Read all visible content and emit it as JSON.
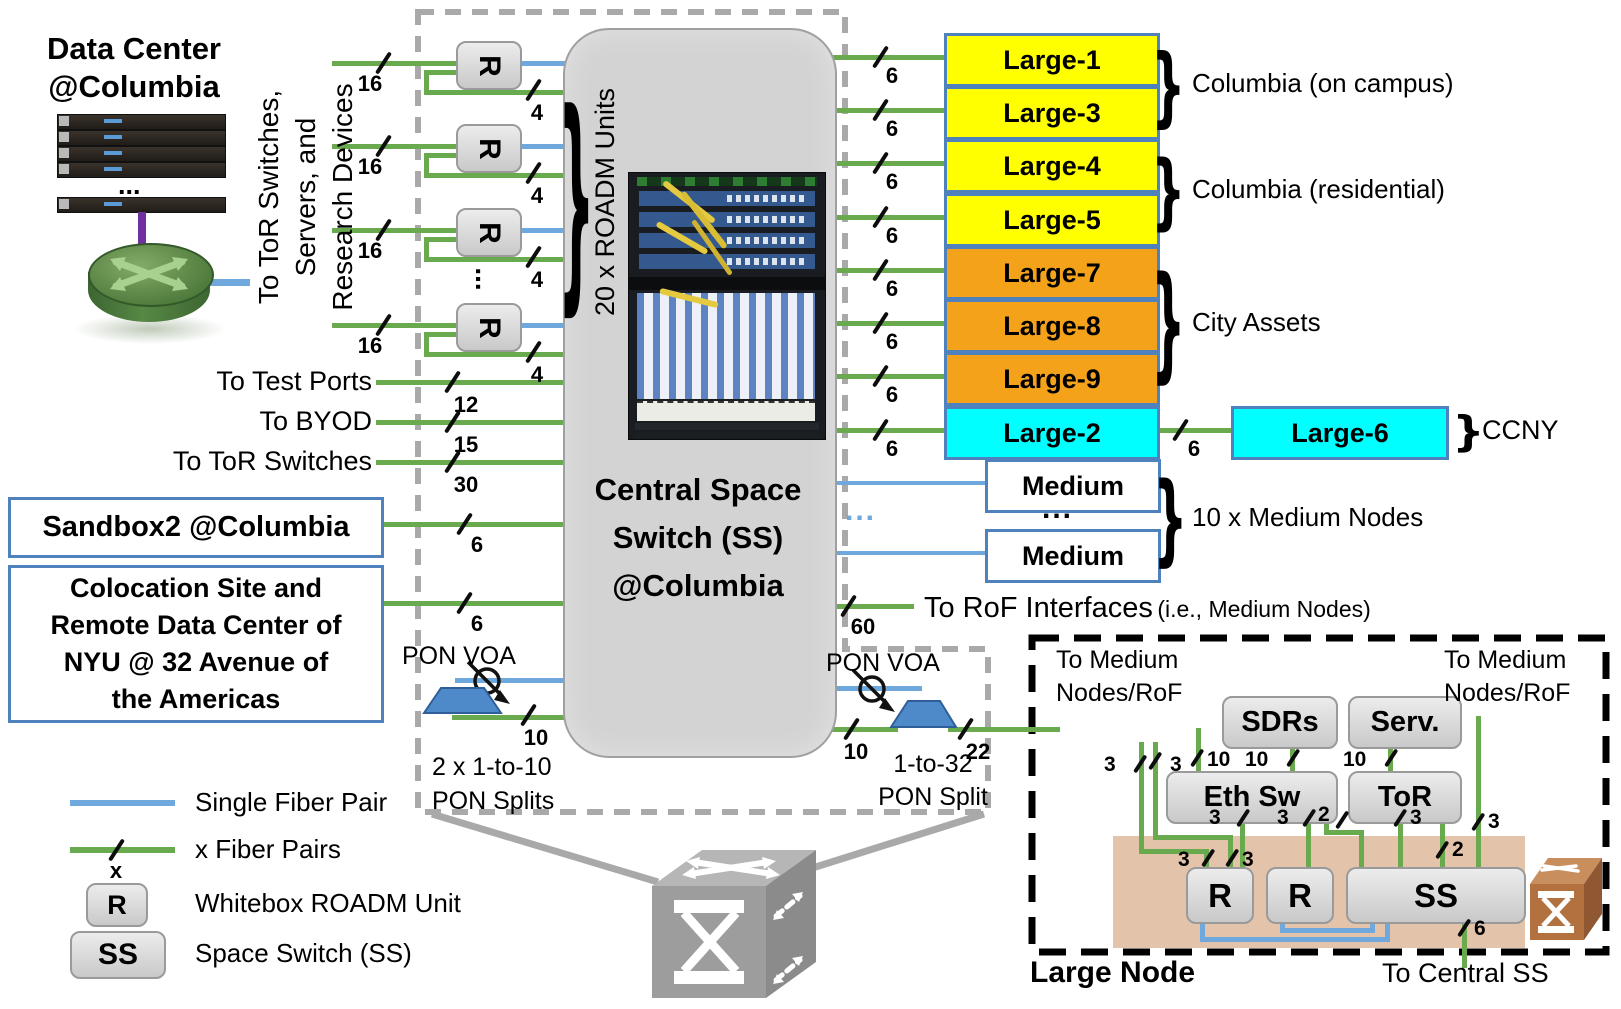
{
  "data_center": {
    "title_line1": "Data Center",
    "title_line2": "@Columbia",
    "dots": "..."
  },
  "left_vertical_label": {
    "line1": "To ToR Switches,",
    "line2": "Servers, and",
    "line3": "Research Devices"
  },
  "roadm_column": {
    "unit_label": "R",
    "dots": "...",
    "group_label": "20 x ROADM Units",
    "rows": [
      {
        "in_count": "16",
        "out_count": "4"
      },
      {
        "in_count": "16",
        "out_count": "4"
      },
      {
        "in_count": "16",
        "out_count": "4"
      },
      {
        "in_count": "16",
        "out_count": "4"
      }
    ]
  },
  "central_switch": {
    "line1": "Central Space",
    "line2": "Switch (SS)",
    "line3": "@Columbia"
  },
  "left_ports": [
    {
      "label": "To Test Ports",
      "count": "12"
    },
    {
      "label": "To BYOD",
      "count": "15"
    },
    {
      "label": "To ToR Switches",
      "count": "30"
    }
  ],
  "sandbox": {
    "label": "Sandbox2 @Columbia",
    "count": "6"
  },
  "colocation": {
    "line1": "Colocation Site and",
    "line2": "Remote Data Center of",
    "line3": "NYU @ 32 Avenue of",
    "line4": "the Americas",
    "count": "6"
  },
  "pon_left": {
    "label": "PON VOA",
    "count": "10",
    "caption1": "2 x 1-to-10",
    "caption2": "PON Splits"
  },
  "pon_right": {
    "label": "PON VOA",
    "count_in": "10",
    "count_out": "22",
    "caption1": "1-to-32",
    "caption2": "PON Split"
  },
  "large_rows": [
    {
      "label": "Large-1",
      "count": "6",
      "color": "yellow"
    },
    {
      "label": "Large-3",
      "count": "6",
      "color": "yellow"
    },
    {
      "label": "Large-4",
      "count": "6",
      "color": "yellow"
    },
    {
      "label": "Large-5",
      "count": "6",
      "color": "yellow"
    },
    {
      "label": "Large-7",
      "count": "6",
      "color": "orange"
    },
    {
      "label": "Large-8",
      "count": "6",
      "color": "orange"
    },
    {
      "label": "Large-9",
      "count": "6",
      "color": "orange"
    },
    {
      "label": "Large-2",
      "count": "6",
      "color": "cyan"
    }
  ],
  "large6": {
    "label": "Large-6",
    "count": "6"
  },
  "medium_rows": {
    "label1": "Medium",
    "label2": "Medium",
    "dots": "...",
    "blue_dots": "..."
  },
  "group_labels": {
    "g1": "Columbia (on campus)",
    "g2": "Columbia (residential)",
    "g3": "City Assets",
    "g4": "CCNY",
    "g5": "10 x Medium Nodes"
  },
  "rof": {
    "count": "60",
    "label": "To RoF Interfaces",
    "sub": "(i.e., Medium Nodes)"
  },
  "legend": {
    "blue_label": "Single Fiber Pair",
    "green_label": "x Fiber Pairs",
    "green_x": "x",
    "r_symbol": "R",
    "r_label": "Whitebox ROADM Unit",
    "ss_symbol": "SS",
    "ss_label": "Space Switch (SS)"
  },
  "inset": {
    "title": "Large Node",
    "to_medium_left_l1": "To Medium",
    "to_medium_left_l2": "Nodes/RoF",
    "to_medium_right_l1": "To Medium",
    "to_medium_right_l2": "Nodes/RoF",
    "to_central": "To Central SS",
    "boxes": {
      "sdrs": "SDRs",
      "serv": "Serv.",
      "ethsw": "Eth Sw",
      "tor": "ToR",
      "r1": "R",
      "r2": "R",
      "ss": "SS"
    },
    "counts": {
      "c3a": "3",
      "c3b": "3",
      "c10a": "10",
      "c10b": "10",
      "c10c": "10",
      "c3c": "3",
      "c3d": "3",
      "c2a": "2",
      "c3e": "3",
      "c2b": "2",
      "c3f": "3",
      "c3g": "3",
      "c3h": "3",
      "c6": "6"
    }
  },
  "colors": {
    "green": "#6aaa4f",
    "blue": "#6fa8dc",
    "yellow": "#ffff00",
    "orange": "#f5a21b",
    "cyan": "#00ffff",
    "box_border": "#4f81bd",
    "dashed_gray": "#a9a9a9",
    "tan": "#e3c4ab"
  }
}
